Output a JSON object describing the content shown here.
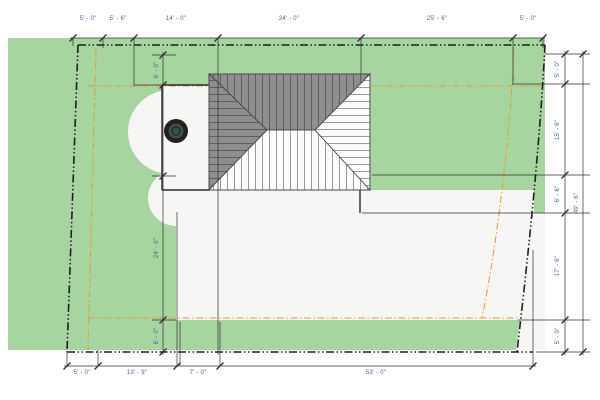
{
  "drawing": {
    "kind": "residential-site-plan"
  },
  "dimensions": {
    "top": [
      {
        "label": "5' - 0\""
      },
      {
        "label": "5' - 6\""
      },
      {
        "label": "14' - 0\""
      },
      {
        "label": "24' - 0\""
      },
      {
        "label": "25' - 6\""
      },
      {
        "label": "5' - 0\""
      }
    ],
    "bottom": [
      {
        "label": "5' - 0\""
      },
      {
        "label": "13' - 9\""
      },
      {
        "label": "7' - 0\""
      },
      {
        "label": "53' - 0\""
      }
    ],
    "right_inner": [
      {
        "label": "5' - 0\""
      },
      {
        "label": "15' - 6\""
      },
      {
        "label": "6' - 6\""
      },
      {
        "label": "17' - 6\""
      },
      {
        "label": "5' - 0\""
      }
    ],
    "right_outer": {
      "label": "49' - 6\""
    },
    "left_inner": [
      {
        "label": "6' - 0\""
      },
      {
        "label": "24' - 0\""
      },
      {
        "label": "6' - 0\""
      }
    ]
  },
  "colors": {
    "lawn_green": "#a6d5a0",
    "lot_white": "#f6f6f5",
    "roof_dark": "#8f8f8f",
    "roof_light": "#fdfdfd",
    "roof_line": "#4a4a4a",
    "setback_dash_black": "#1f1f1f",
    "easement_orange": "#e8993a",
    "dimension_line": "#2f2f2f",
    "dimension_text": "#4e5d94",
    "tree_ring": "#26201c",
    "tree_center": "#37504f"
  }
}
